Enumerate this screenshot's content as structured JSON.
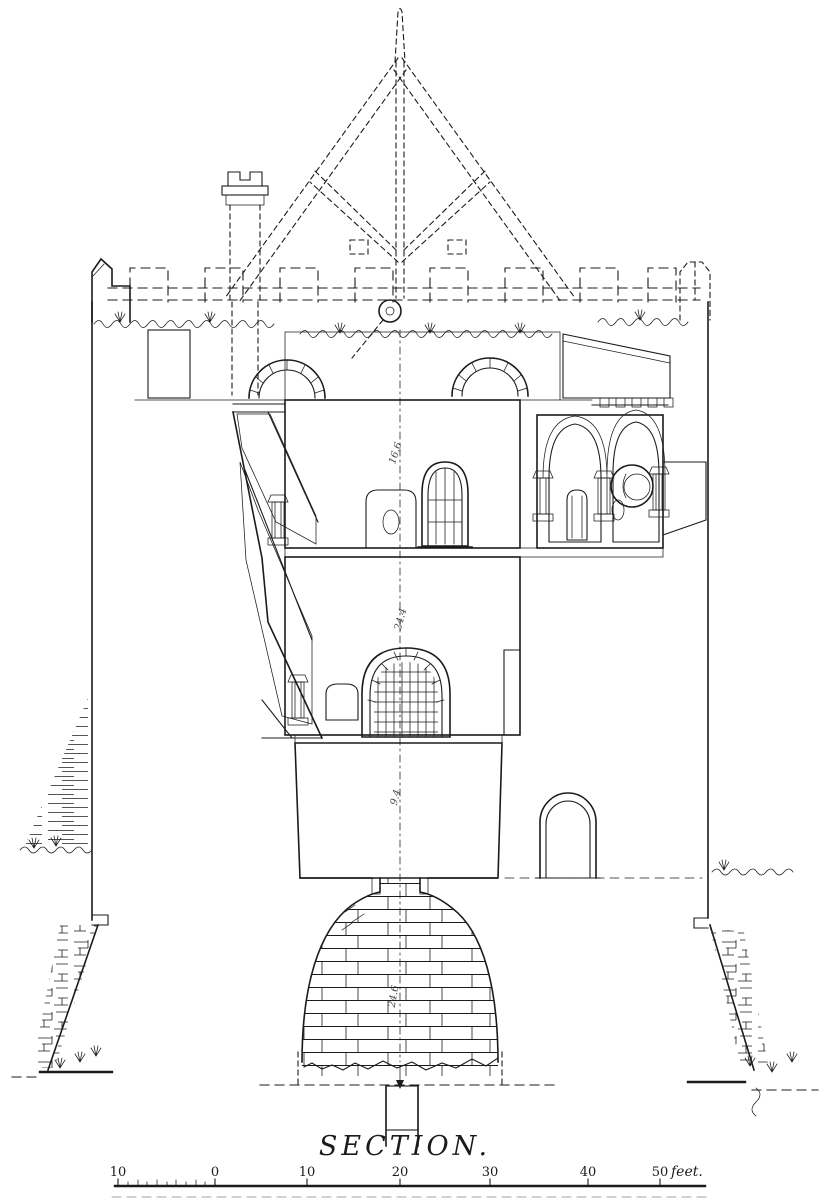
{
  "colors": {
    "paper": "#ffffff",
    "ink": "#1b1b1b"
  },
  "caption": {
    "text": "SECTION."
  },
  "scale_bar": {
    "labels": [
      "10",
      "0",
      "10",
      "20",
      "30",
      "40",
      "50"
    ],
    "unit": "feet."
  },
  "dimension_annotations": [
    "16.6",
    "24.4",
    "9.4",
    "24.6"
  ]
}
